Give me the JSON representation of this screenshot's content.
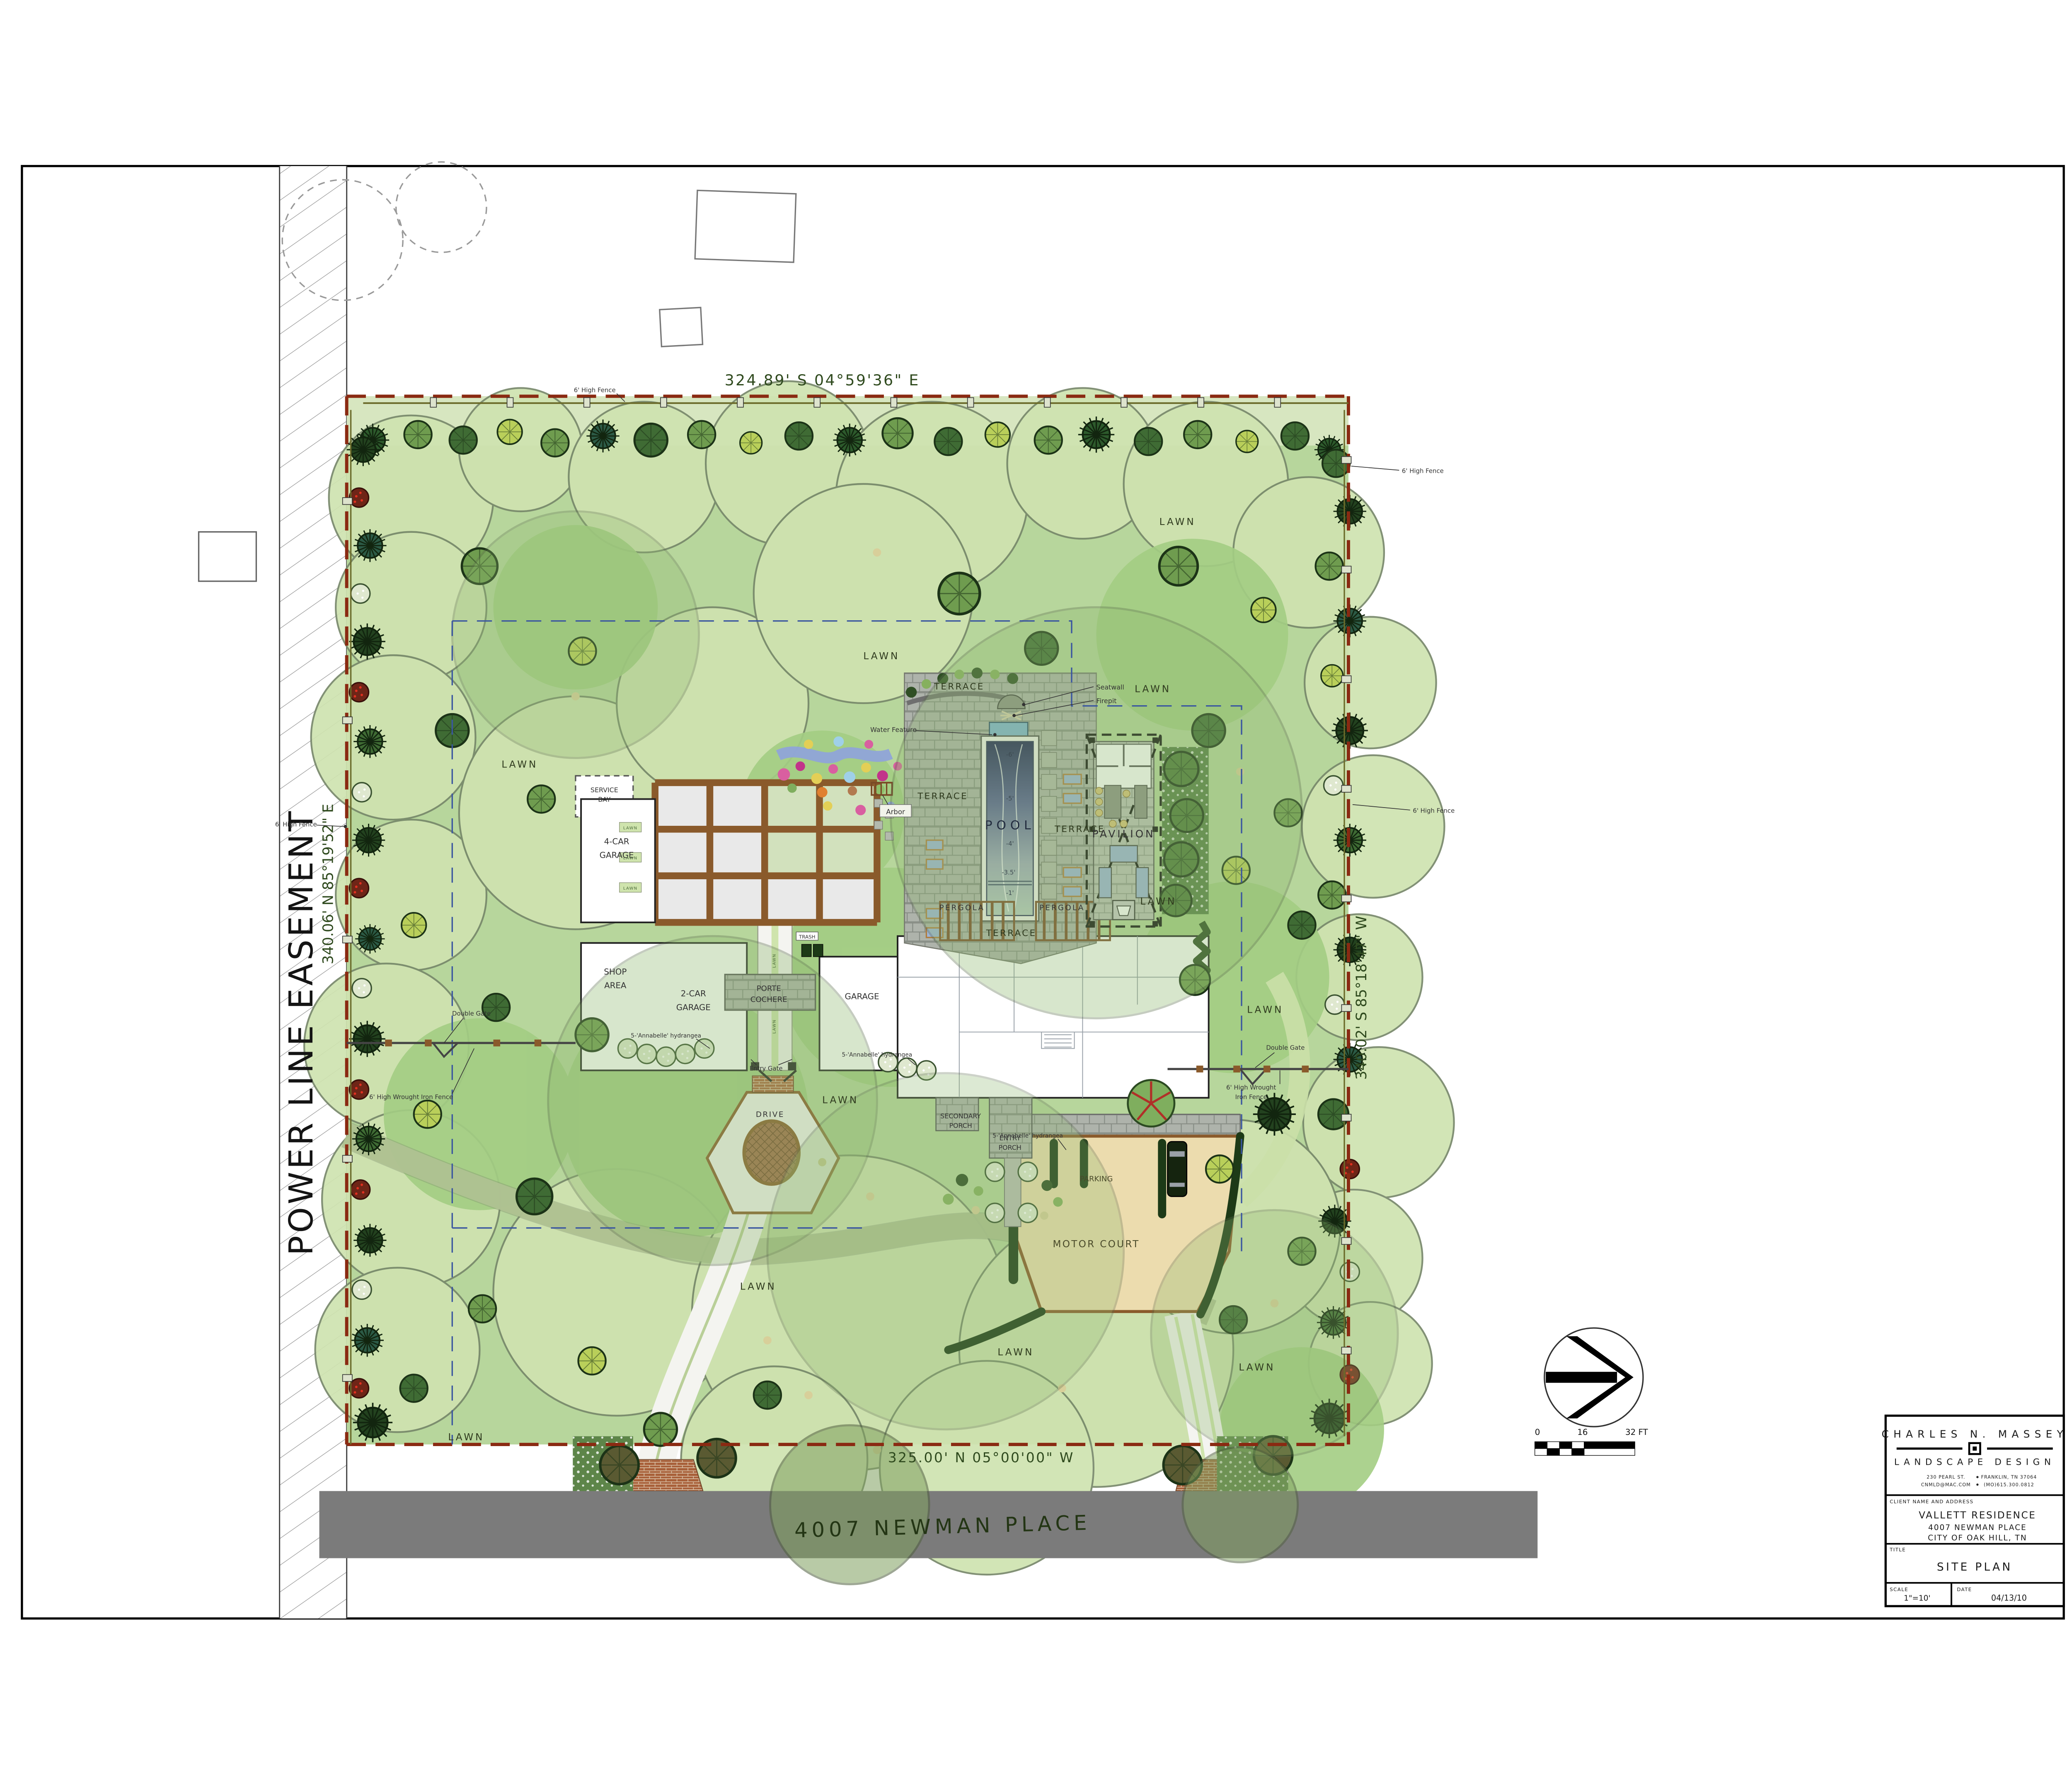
{
  "title_block": {
    "firm_name": "CHARLES N. MASSEY",
    "firm_tagline": "LANDSCAPE DESIGN",
    "address_left": "230 PEARL ST.",
    "address_right": "FRANKLIN, TN 37064",
    "contact_left": "CNMLD@MAC.COM",
    "contact_right": "(MO)615.300.0812",
    "client_label": "CLIENT NAME AND ADDRESS",
    "client_name": "VALLETT RESIDENCE",
    "client_address_line1": "4007 NEWMAN PLACE",
    "client_address_line2": "CITY OF OAK HILL, TN",
    "title_label": "TITLE",
    "sheet_title": "SITE PLAN",
    "scale_label": "SCALE",
    "scale_value": "1\"=10'",
    "date_label": "DATE",
    "date_value": "04/13/10"
  },
  "dimensions": {
    "north": "324.89'   S 04°59'36\" E",
    "south": "325.00'   N 05°00'00\" W",
    "west": "340.06'   N 85°19'52\" E",
    "east": "340.02'   S 85°18'47\" W"
  },
  "easement_label": "POWER LINE EASEMENT",
  "street_name": "4007 NEWMAN PLACE",
  "scale_bar": {
    "tick0": "0",
    "tick16": "16",
    "tick32": "32 FT"
  },
  "labels": {
    "lawn": "LAWN",
    "drive": "DRIVE",
    "terrace": "TERRACE",
    "pool": "POOL",
    "pavilion": "PAVILION",
    "pergola": "PERGOLA",
    "motor_court": "MOTOR COURT",
    "parking": "PARKING",
    "porte_l1": "PORTE",
    "porte_l2": "COCHERE",
    "garage": "GARAGE",
    "two_car_l1": "2-CAR",
    "two_car_l2": "GARAGE",
    "four_car_l1": "4-CAR",
    "four_car_l2": "GARAGE",
    "shop_l1": "SHOP",
    "shop_l2": "AREA",
    "service_l1": "SERVICE",
    "service_l2": "BAY",
    "secondary_l1": "SECONDARY",
    "secondary_l2": "PORCH",
    "entry_porch_l1": "ENTRY",
    "entry_porch_l2": "PORCH",
    "entry_gate": "Entry Gate",
    "double_gate": "Double Gate",
    "wrought_iron_fence": "6' High Wrought Iron Fence",
    "wrought_iron_fence_l1": "6' High Wrought",
    "wrought_iron_fence_l2": "Iron Fence",
    "high_fence": "6' High Fence",
    "seatwall": "Seatwall",
    "firepit": "Firepit",
    "water_feature": "Water Feature",
    "arbor": "Arbor",
    "hydrangea": "5-'Annabelle' hydrangea",
    "trash": "TRASH"
  },
  "pool_depths": [
    "-6'",
    "-5'",
    "-4'",
    "-3.5'",
    "-1'"
  ],
  "icons": {
    "north_arrow": "arrow-right-in-circle",
    "firm_logo": "nested-squares"
  },
  "palette": {
    "boundary_red": "#8a2a12",
    "fence_olive": "#6b6b2a",
    "street_gray": "#7b7b7b",
    "lawn_green": "#b7d69c",
    "canopy_green": "#cfe3b0",
    "pool_blue": "#1f2356",
    "motor_court_tan": "#ecdcae",
    "setback_blue": "#3a56a0",
    "trellis_brown": "#8a5a2b"
  }
}
